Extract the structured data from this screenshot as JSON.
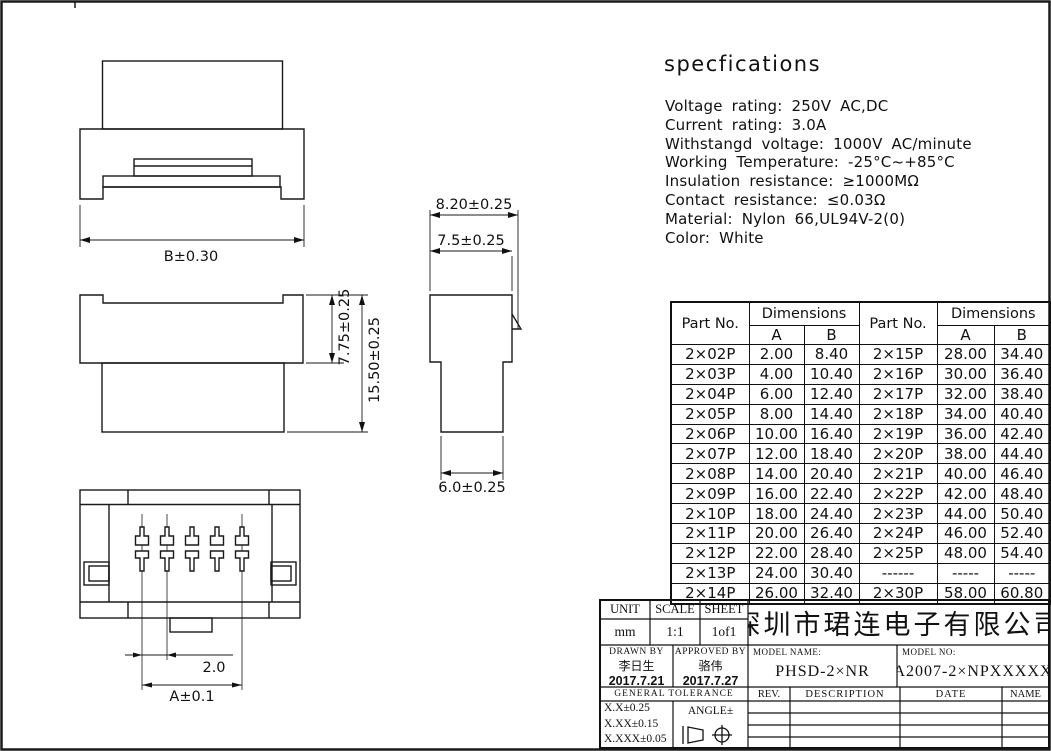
{
  "specs": {
    "title": "specfications",
    "lines": [
      "Voltage rating: 250V AC,DC",
      "Current rating: 3.0A",
      "Withstangd voltage: 1000V AC/minute",
      "Working Temperature: -25°C~+85°C",
      "Insulation resistance: ≥1000MΩ",
      "Contact resistance: ≤0.03Ω",
      "Material: Nylon 66,UL94V-2(0)",
      "Color: White"
    ]
  },
  "dimensions": {
    "front_width": "B±0.30",
    "side_upper_height": "7.75±0.25",
    "side_total_height": "15.50±0.25",
    "profile_total_width": "8.20±0.25",
    "profile_body_width": "7.5±0.25",
    "profile_lower_width": "6.0±0.25",
    "pin_pitch": "2.0",
    "pin_span": "A±0.1"
  },
  "parts_table": {
    "header": {
      "part_no": "Part No.",
      "dimensions": "Dimensions",
      "col_a": "A",
      "col_b": "B"
    },
    "rows_left": [
      [
        "2×02P",
        "2.00",
        "8.40"
      ],
      [
        "2×03P",
        "4.00",
        "10.40"
      ],
      [
        "2×04P",
        "6.00",
        "12.40"
      ],
      [
        "2×05P",
        "8.00",
        "14.40"
      ],
      [
        "2×06P",
        "10.00",
        "16.40"
      ],
      [
        "2×07P",
        "12.00",
        "18.40"
      ],
      [
        "2×08P",
        "14.00",
        "20.40"
      ],
      [
        "2×09P",
        "16.00",
        "22.40"
      ],
      [
        "2×10P",
        "18.00",
        "24.40"
      ],
      [
        "2×11P",
        "20.00",
        "26.40"
      ],
      [
        "2×12P",
        "22.00",
        "28.40"
      ],
      [
        "2×13P",
        "24.00",
        "30.40"
      ],
      [
        "2×14P",
        "26.00",
        "32.40"
      ]
    ],
    "rows_right": [
      [
        "2×15P",
        "28.00",
        "34.40"
      ],
      [
        "2×16P",
        "30.00",
        "36.40"
      ],
      [
        "2×17P",
        "32.00",
        "38.40"
      ],
      [
        "2×18P",
        "34.00",
        "40.40"
      ],
      [
        "2×19P",
        "36.00",
        "42.40"
      ],
      [
        "2×20P",
        "38.00",
        "44.40"
      ],
      [
        "2×21P",
        "40.00",
        "46.40"
      ],
      [
        "2×22P",
        "42.00",
        "48.40"
      ],
      [
        "2×23P",
        "44.00",
        "50.40"
      ],
      [
        "2×24P",
        "46.00",
        "52.40"
      ],
      [
        "2×25P",
        "48.00",
        "54.40"
      ],
      [
        "------",
        "-----",
        "-----"
      ],
      [
        "2×30P",
        "58.00",
        "60.80"
      ]
    ]
  },
  "title_block": {
    "unit_label": "UNIT",
    "unit_value": "mm",
    "scale_label": "SCALE",
    "scale_value": "1:1",
    "sheet_label": "SHEET",
    "sheet_value": "1of1",
    "company": "深圳市珺连电子有限公司",
    "drawn_by_label": "DRAWN BY",
    "drawn_by_name": "李日生",
    "drawn_by_date": "2017.7.21",
    "approved_by_label": "APPROVED BY",
    "approved_by_name": "骆伟",
    "approved_by_date": "2017.7.27",
    "model_name_label": "MODEL NAME:",
    "model_name": "PHSD-2×NR",
    "model_no_label": "MODEL NO:",
    "model_no": "A2007-2×NPXXXXX",
    "general_tolerance_label": "GENERAL TOLERANCE",
    "tolerances": [
      "X.X±0.25",
      "X.XX±0.15",
      "X.XXX±0.05"
    ],
    "angle_label": "ANGLE±",
    "rev_label": "REV.",
    "description_label": "DESCRIPTION",
    "date_label": "DATE",
    "name_label": "NAME"
  }
}
